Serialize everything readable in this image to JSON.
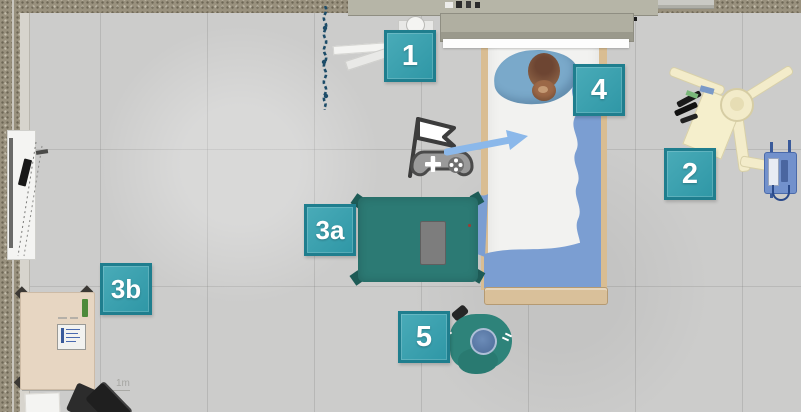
{
  "app": {
    "view": "top-down hospital room simulation",
    "scale_label": "1m"
  },
  "markers": [
    {
      "id": "marker-1",
      "label": "1"
    },
    {
      "id": "marker-2",
      "label": "2"
    },
    {
      "id": "marker-3a",
      "label": "3a"
    },
    {
      "id": "marker-3b",
      "label": "3b"
    },
    {
      "id": "marker-4",
      "label": "4"
    },
    {
      "id": "marker-5",
      "label": "5"
    }
  ],
  "icons": {
    "start_point": "flag-gamepad-icon",
    "direction": "arrow-right-icon"
  },
  "scene_objects": [
    "hospital-bed",
    "patient",
    "pillow",
    "teddy-bear",
    "instrument-table",
    "instrument-tray",
    "clinician-seated",
    "overhead-machine",
    "infusion-pump",
    "desk",
    "clipboard",
    "office-chair",
    "paper-sheet",
    "whiteboard",
    "privacy-curtain",
    "headwall-unit",
    "wall-rail"
  ],
  "colors": {
    "marker_fill": "#36a3b0",
    "marker_border": "#1f7e8e",
    "floor": "#cbcbc9",
    "wall": "#99917e",
    "table_drape": "#2c7a74",
    "blanket": "#7b9ed2",
    "scrubs": "#2e837a",
    "arrow": "#8bb8ea",
    "machine_cream": "#f3ecca",
    "curtain_navy": "#1d4c68",
    "bed_wood": "#d9bd92"
  }
}
